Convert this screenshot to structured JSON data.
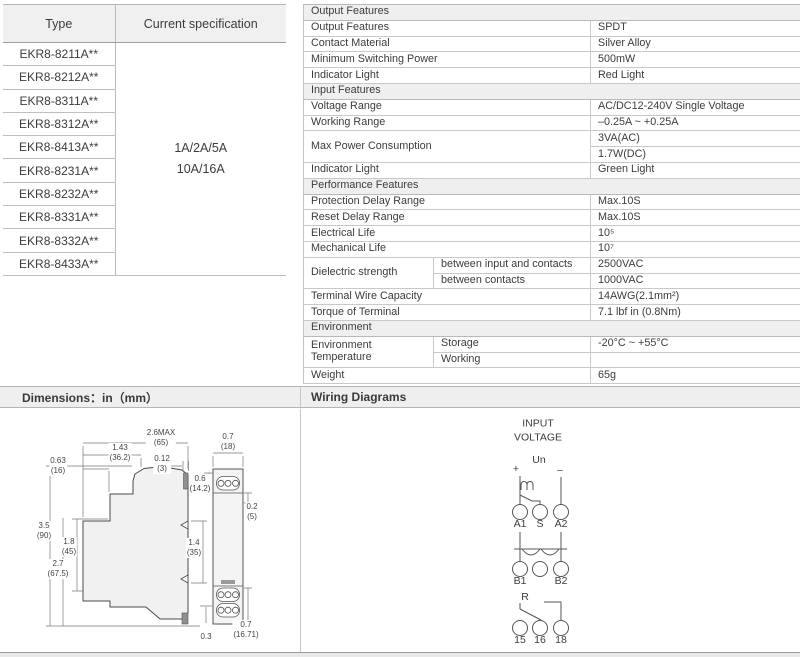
{
  "colors": {
    "section_bg": "#efefef",
    "border": "#c9c9c9",
    "text": "#3c3c3c"
  },
  "type_table": {
    "headers": [
      "Type",
      "Current specification"
    ],
    "types": [
      "EKR8-8211A**",
      "EKR8-8212A**",
      "EKR8-8311A**",
      "EKR8-8312A**",
      "EKR8-8413A**",
      "EKR8-8231A**",
      "EKR8-8232A**",
      "EKR8-8331A**",
      "EKR8-8332A**",
      "EKR8-8433A**"
    ],
    "current_spec": [
      "1A/2A/5A",
      "10A/16A"
    ]
  },
  "spec": {
    "rows": [
      {
        "type": "section",
        "label": "Output Features"
      },
      {
        "label": "Output Features",
        "value": "SPDT"
      },
      {
        "label": "Contact Material",
        "value": "Silver Alloy"
      },
      {
        "label": "Minimum Switching Power",
        "value": "500mW"
      },
      {
        "label": "Indicator Light",
        "value": "Red Light"
      },
      {
        "type": "section",
        "label": "Input Features"
      },
      {
        "label": "Voltage Range",
        "value": "AC/DC12-240V Single Voltage"
      },
      {
        "label": "Working Range",
        "value": "–0.25A ~ +0.25A"
      },
      {
        "label": "Max Power Consumption",
        "value": "3VA(AC)",
        "value2": "1.7W(DC)"
      },
      {
        "label": "Indicator Light",
        "value": "Green Light"
      },
      {
        "type": "section",
        "label": "Performance Features"
      },
      {
        "label": "Protection Delay Range",
        "value": "Max.10S"
      },
      {
        "label": "Reset Delay Range",
        "value": "Max.10S"
      },
      {
        "label": "Electrical Life",
        "value": "10⁵"
      },
      {
        "label": "Mechanical Life",
        "value": "10⁷"
      },
      {
        "label": "Dielectric strength",
        "sub1": "between input and contacts",
        "value": "2500VAC",
        "sub2": "between contacts",
        "value2": "1000VAC"
      },
      {
        "label": "Terminal Wire Capacity",
        "value": "14AWG(2.1mm²)"
      },
      {
        "label": "Torque of Terminal",
        "value": "7.1 lbf in (0.8Nm)"
      },
      {
        "type": "section",
        "label": "Environment"
      },
      {
        "label": "Environment Temperature",
        "sub1": "Storage",
        "value": "-20°C ~ +55°C",
        "sub2": "Working"
      },
      {
        "label": "Weight",
        "value": "65g"
      }
    ]
  },
  "dims": {
    "header": "Dimensions：in（mm）",
    "labels": [
      "2.6MAX\n(65)",
      "1.43\n(36.2)",
      "0.63\n(16)",
      "0.12\n(3)",
      "0.7\n(18)",
      "0.6\n(14.2)",
      "0.2\n(5)",
      "3.5\n(90)",
      "1.8\n(45)",
      "2.7\n(67.5)",
      "1.4\n(35)",
      "0.3",
      "0.7\n(16.71)"
    ]
  },
  "wiring": {
    "header": "Wiring Diagrams",
    "title": "INPUT\nVOLTAGE",
    "un": "Un",
    "plus": "+",
    "minus": "–",
    "m_symbol": "m",
    "row1": [
      "A1",
      "S",
      "A2"
    ],
    "row2": [
      "B1",
      "B2"
    ],
    "r": "R",
    "row3": [
      "15",
      "16",
      "18"
    ]
  }
}
